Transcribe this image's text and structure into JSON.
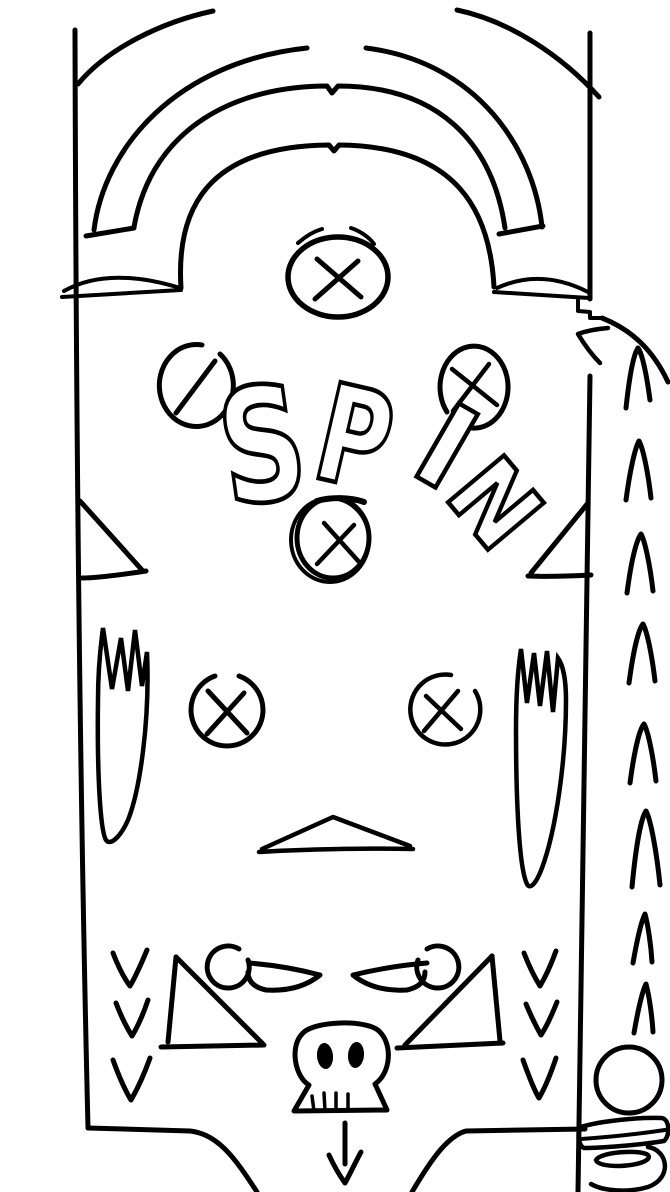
{
  "canvas": {
    "width": 670,
    "height": 1192,
    "background": "#ffffff",
    "ink": "#000000"
  },
  "spin": {
    "word": "SPIN",
    "letters": [
      "S",
      "P",
      "I",
      "N"
    ]
  },
  "sketch": {
    "type": "hand-drawn pinball playfield",
    "bumper_symbol": "X",
    "x_bumper_count": 5,
    "slash_target_count": 1,
    "lane_chevrons_up_count": 8,
    "outlane_chevrons_down_left": 3,
    "outlane_chevrons_down_right": 3,
    "flipper_count": 2,
    "slingshot_count": 2,
    "skull_present": true,
    "drain_arrow_direction": "down",
    "plunger_ball_present": true
  }
}
